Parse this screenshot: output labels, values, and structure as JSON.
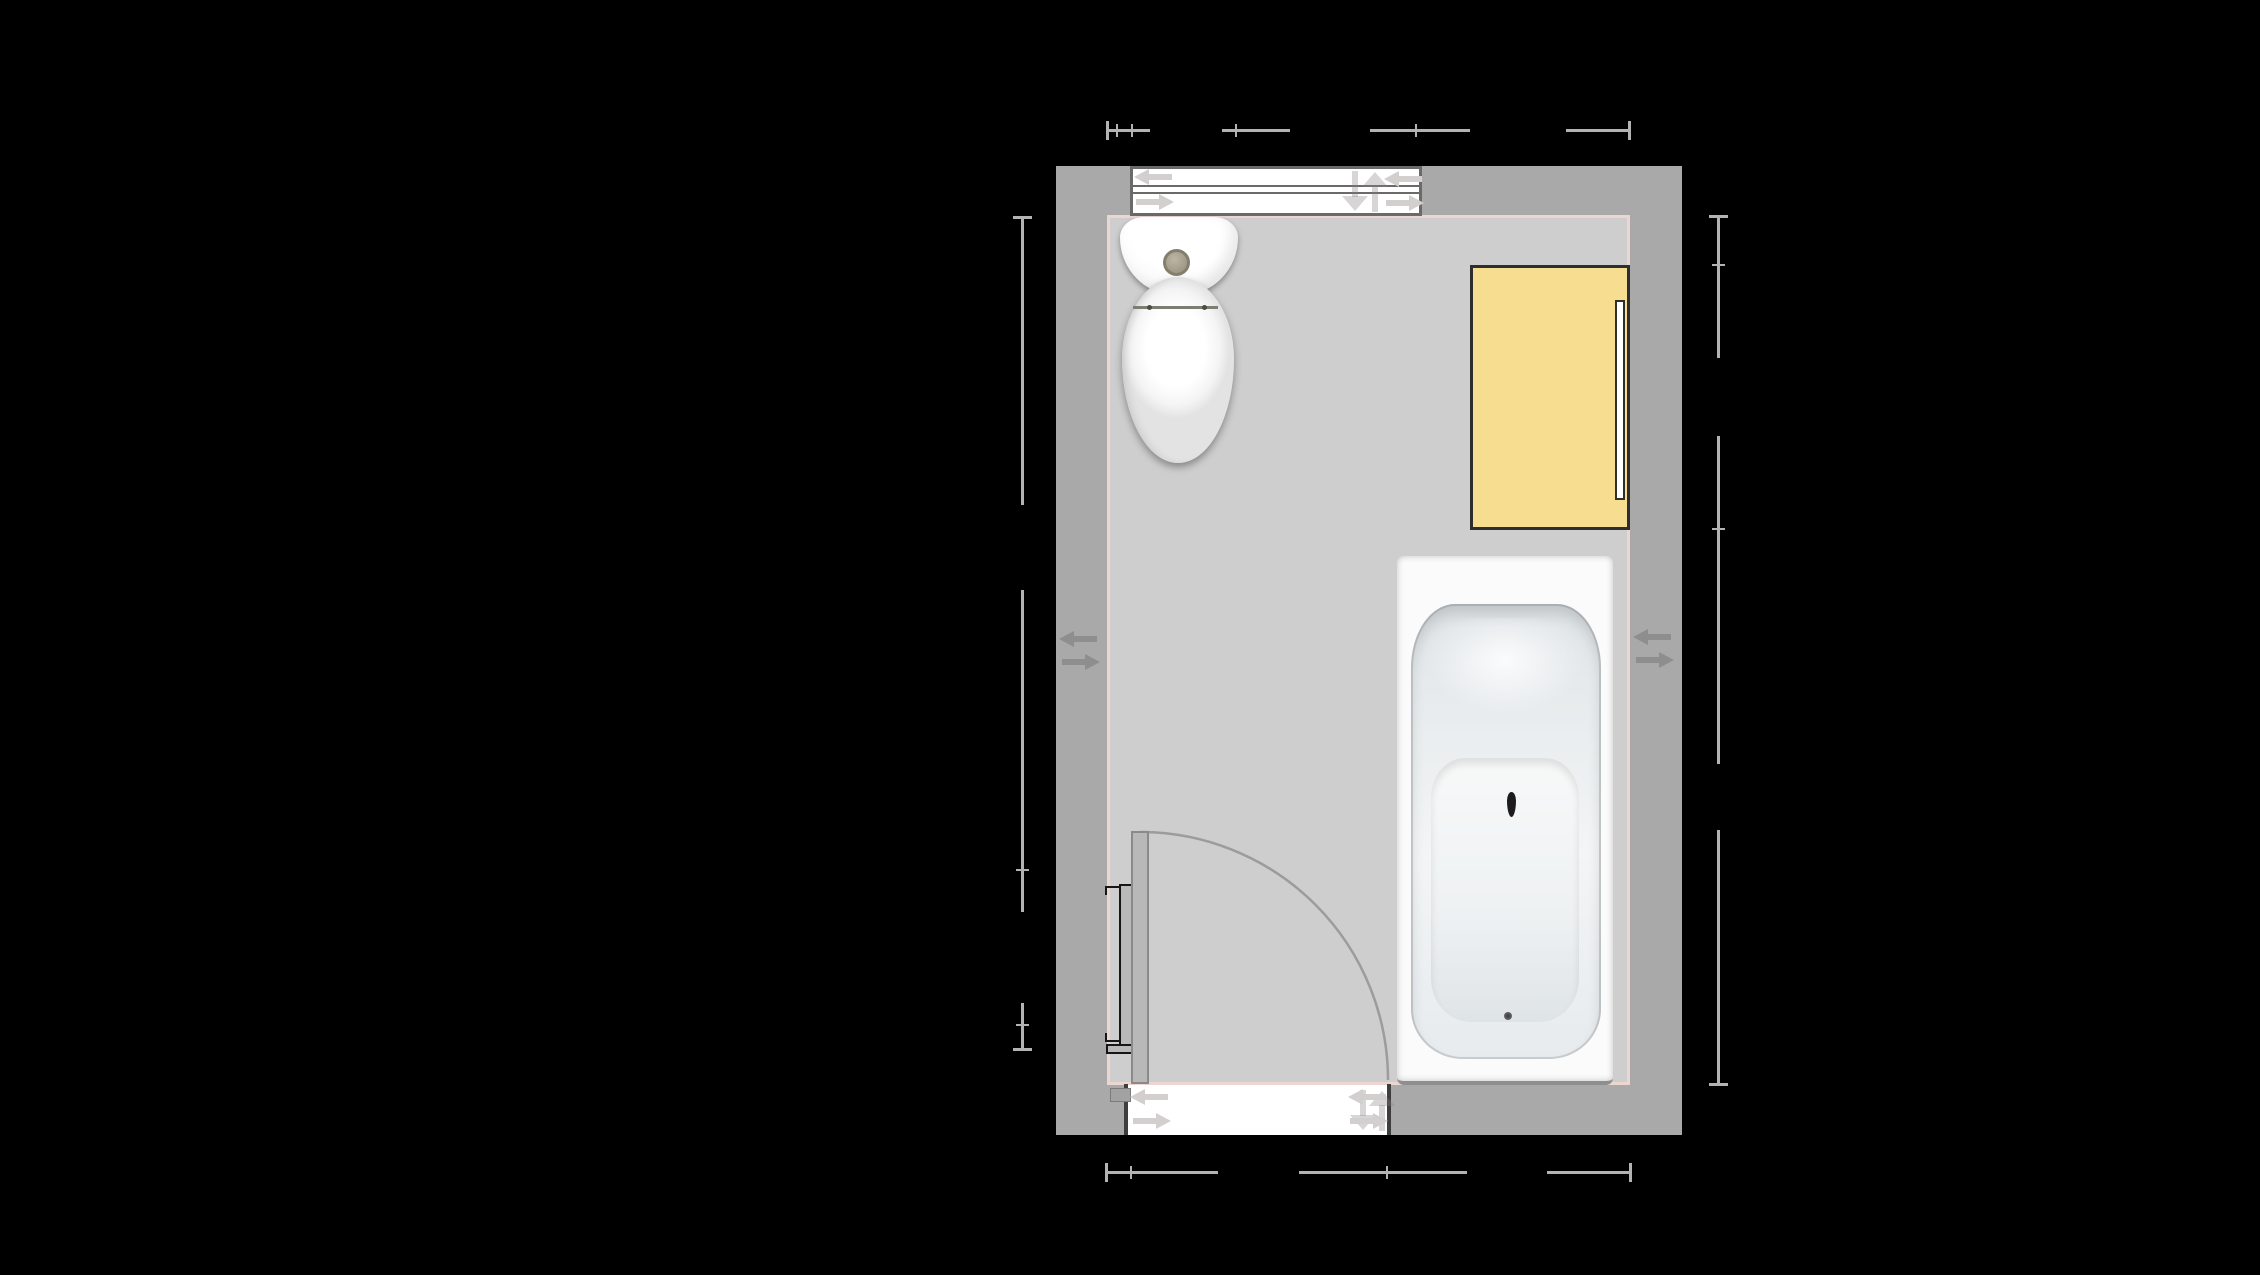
{
  "scene": {
    "type": "bathroom-floor-plan",
    "view": "top-down plan on black canvas",
    "visible_text": "none",
    "dimension_labels_visible": false,
    "dimension_chains": [
      "top",
      "bottom",
      "left",
      "right"
    ]
  },
  "colors": {
    "background": "#000000",
    "wall": "#a9a9a9",
    "floor": "#cecece",
    "innerline": "#eed6d0",
    "dim": "#b3b3b3",
    "cabinet": "#f6dd8f",
    "cabinet_border": "#2e2e2e",
    "frame_window": "#6a6a6a",
    "frame_opening": "#3e3e3e",
    "leaf": "#b8b8b8",
    "arc": "#9c9c9c",
    "radiator": "#161616",
    "arrow_wall": "#8e8e8e",
    "arrow_opening": "#d3cfcf",
    "arrow_ghost": "rgba(130,125,125,0.32)"
  },
  "fixtures": [
    {
      "id": "sliding-window",
      "label": "Sliding window on top wall"
    },
    {
      "id": "toilet",
      "label": "Toilet against top wall"
    },
    {
      "id": "wall-cabinet",
      "label": "Yellow cabinet on right wall"
    },
    {
      "id": "bathtub",
      "label": "Bathtub along right wall"
    },
    {
      "id": "radiator",
      "label": "Radiator on left wall"
    },
    {
      "id": "hinged-door",
      "label": "Hinged door in bottom wall with quarter-circle swing"
    }
  ],
  "indicators": {
    "wall_move_arrows": "left/right arrow pair on left wall and right wall",
    "opening_move_arrows": "left/right arrow pairs at both ends of window and doorway",
    "ghost_arrows": "faint up/down arrows near right end of window and doorway"
  }
}
